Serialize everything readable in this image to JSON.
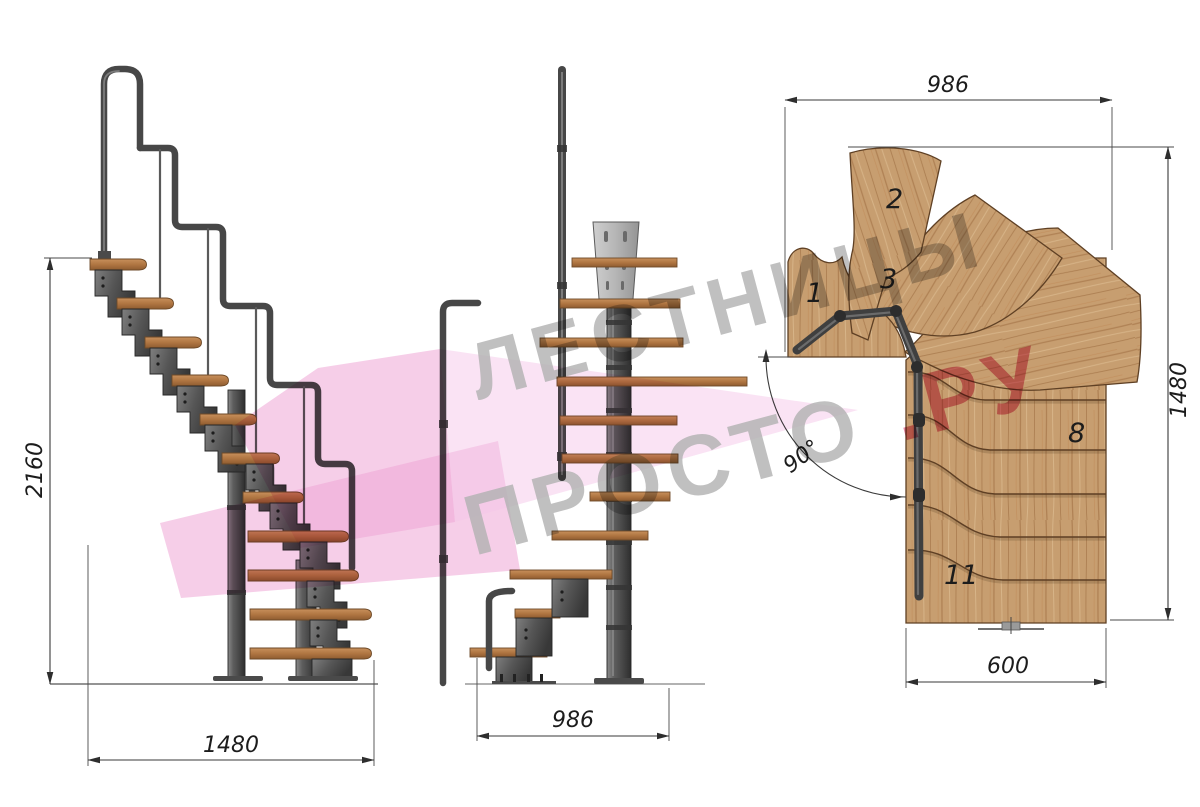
{
  "drawing": {
    "description": "Modular staircase technical drawing, three views",
    "views": {
      "side": "side elevation",
      "front": "front elevation",
      "plan": "top plan view"
    }
  },
  "side_view": {
    "height_dim": "2160",
    "width_dim": "1480"
  },
  "front_view": {
    "width_dim": "986"
  },
  "plan_view": {
    "width_dim": "986",
    "height_dim": "1480",
    "lower_width_dim": "600",
    "angle_dim": "90°",
    "step_labels": [
      "1",
      "2",
      "3",
      "8",
      "11"
    ]
  },
  "watermark": {
    "line1": "ЛЕСТНИЦЫ",
    "line2_gray": "ПРОСТО",
    "line2_pink": ".РУ",
    "gray": "#b3b3b3",
    "pink": "#e0708e",
    "arrow_pink": "#eea5d6",
    "arrow_pink_light": "#f5c7e9"
  },
  "colors": {
    "background": "#ffffff",
    "wood_plan": "#c79e70",
    "wood_side": "#b57b48",
    "metal": "#555555",
    "dimension": "#333333"
  }
}
